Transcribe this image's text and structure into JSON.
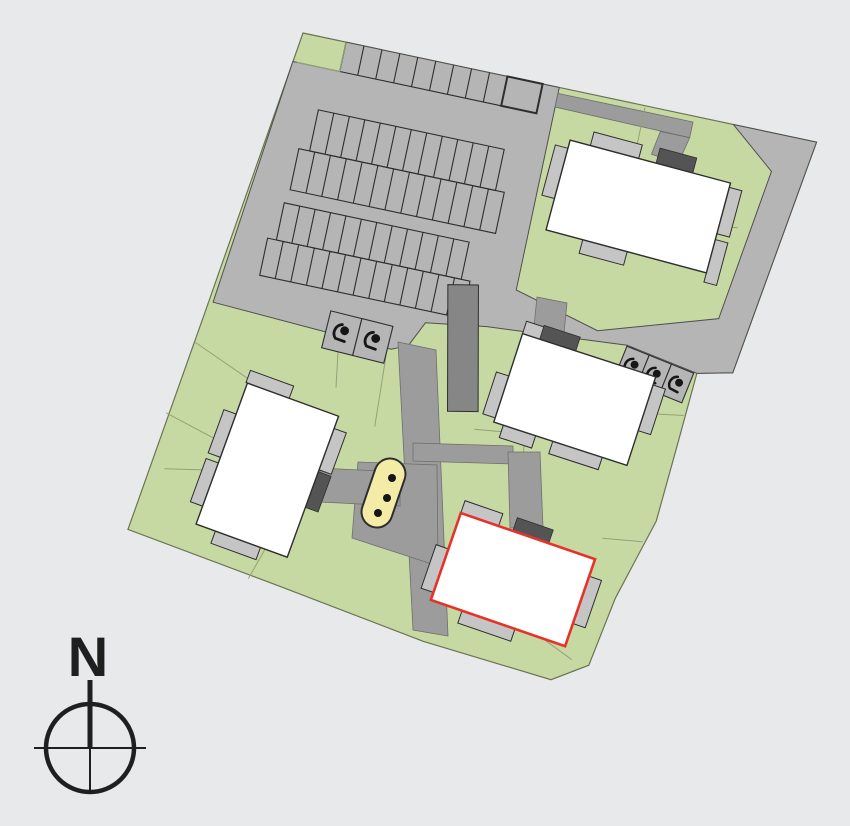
{
  "compass": {
    "north_label": "N"
  },
  "site": {
    "type": "residential-site-plan",
    "buildings": [
      {
        "id": "building-1",
        "position": "top-right",
        "selected": false
      },
      {
        "id": "building-2",
        "position": "left",
        "selected": false
      },
      {
        "id": "building-3",
        "position": "center-right",
        "selected": false
      },
      {
        "id": "building-4",
        "position": "bottom-center",
        "selected": true,
        "highlight_color": "#e6332a"
      }
    ],
    "parking": {
      "standard_rows": [
        {
          "name": "top-edge-row",
          "stalls": 10
        },
        {
          "name": "upper-pair-north",
          "stalls": 12
        },
        {
          "name": "upper-pair-south",
          "stalls": 13
        },
        {
          "name": "lower-pair-north",
          "stalls": 12
        },
        {
          "name": "lower-pair-south",
          "stalls": 13
        }
      ],
      "accessible_groups": [
        {
          "name": "west-group",
          "stalls": 2,
          "icon": "wheelchair-icon"
        },
        {
          "name": "east-group",
          "stalls": 3,
          "icon": "wheelchair-icon"
        }
      ]
    },
    "play_area": {
      "dots": 3
    }
  },
  "colors": {
    "background": "#e8e9eb",
    "green": "#c6d9a2",
    "site-border": "#6a7452",
    "asphalt": "#b5b5b5",
    "asphalt-border": "#4f4f4f",
    "stall-line": "#2e2e2e",
    "path": "#9c9c9c",
    "path-border": "#6e6e6e",
    "dark-block": "#868686",
    "parcel-line": "#94a178",
    "terrace": "#c5c5c5",
    "entrance": "#545454",
    "building": "#ffffff",
    "highlight": "#e6332a",
    "play-area": "#f4eba6",
    "icon": "#161616",
    "compass": "#1f1f1f"
  }
}
